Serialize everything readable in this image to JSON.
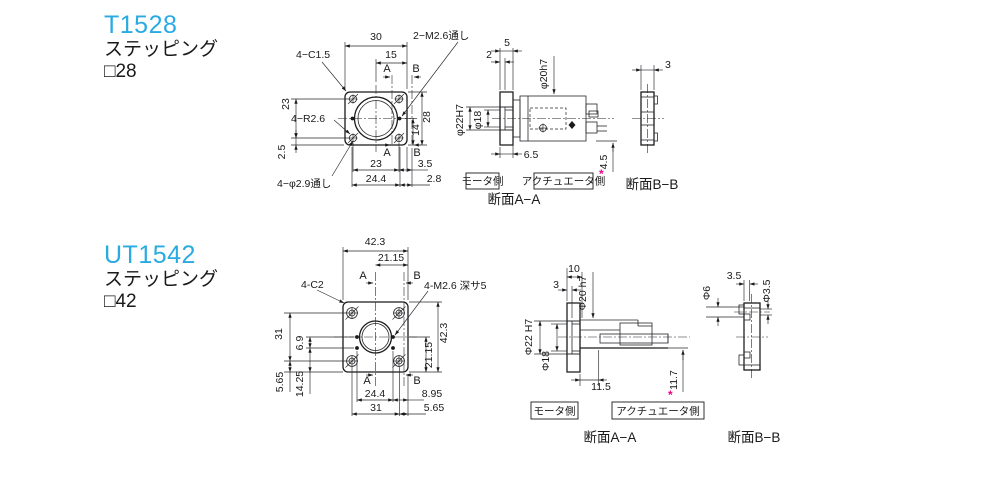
{
  "colors": {
    "accent": "#29abe2",
    "line": "#1a1a1c",
    "flange_fill": "#e4e5e7",
    "footnote": "#ec008c"
  },
  "t1528": {
    "title": "T1528",
    "subtitle": "ステッピング",
    "size": "□28",
    "front": {
      "d30": "30",
      "d15": "15",
      "a": "A",
      "b": "B",
      "tap": "2−M2.6通し",
      "chamfer": "4−C1.5",
      "d23l": "23",
      "radius": "4−R2.6",
      "d25": "2.5",
      "hole": "4−φ2.9通し",
      "d28": "28",
      "d14": "14",
      "d23b": "23",
      "d35": "3.5",
      "d244": "24.4",
      "d28b": "2.8"
    },
    "secA": {
      "d5": "5",
      "d2": "2",
      "shaft": "φ20h7",
      "bore": "φ22H7",
      "inner": "φ18",
      "d65": "6.5",
      "d45": "4.5",
      "star": "*",
      "motor_side": "モータ側",
      "actuator_side": "アクチュエータ側",
      "label": "断面A−A"
    },
    "secB": {
      "d3": "3",
      "label": "断面B−B"
    }
  },
  "ut1542": {
    "title": "UT1542",
    "subtitle": "ステッピング",
    "size": "□42",
    "front": {
      "d423": "42.3",
      "d2115": "21.15",
      "a": "A",
      "b": "B",
      "chamfer": "4-C2",
      "tap": "4-M2.6 深サ5",
      "d31l": "31",
      "d69": "6.9",
      "d565l": "5.65",
      "d1425": "14.25",
      "d423r": "42.3",
      "d2115r": "21.15",
      "d244": "24.4",
      "d895": "8.95",
      "d31b": "31",
      "d565b": "5.65"
    },
    "secA": {
      "d10": "10",
      "d3": "3",
      "shaft": "Φ20 h7",
      "bore": "Φ22 H7",
      "inner": "Φ18",
      "d115": "11.5",
      "d117": "11.7",
      "star": "*",
      "motor_side": "モータ側",
      "actuator_side": "アクチュエータ側",
      "label": "断面A−A"
    },
    "secB": {
      "d35": "3.5",
      "d6": "Φ6",
      "d35b": "Φ3.5",
      "label": "断面B−B"
    }
  }
}
